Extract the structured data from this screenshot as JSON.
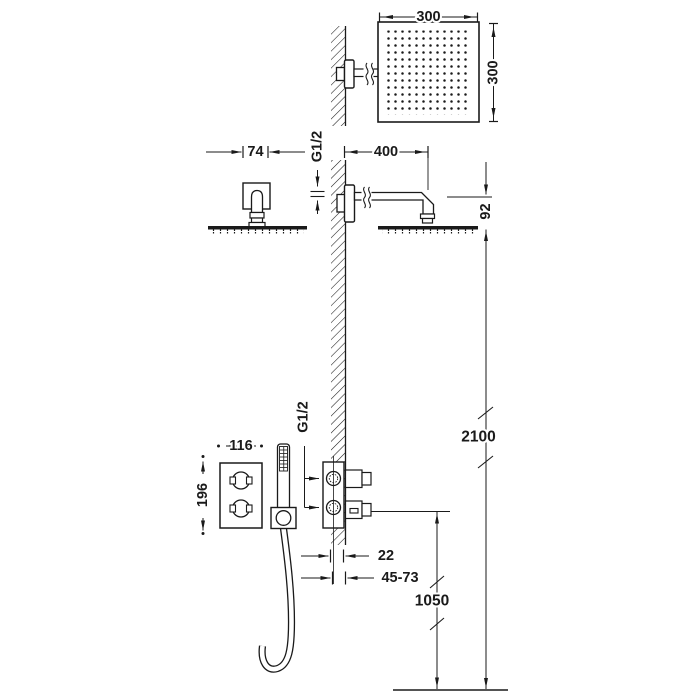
{
  "labels": {
    "head_width": "300",
    "head_height": "300",
    "flange_width": "74",
    "arm_thread": "G1/2",
    "arm_length": "400",
    "arm_drop": "92",
    "head_height_from_floor": "2100",
    "valve_width": "116",
    "valve_height": "196",
    "valve_thread": "G1/2",
    "depth_min": "22",
    "depth_range": "45-73",
    "outlet_height": "1050"
  },
  "colors": {
    "line": "#1a1a1a",
    "background": "#ffffff"
  }
}
